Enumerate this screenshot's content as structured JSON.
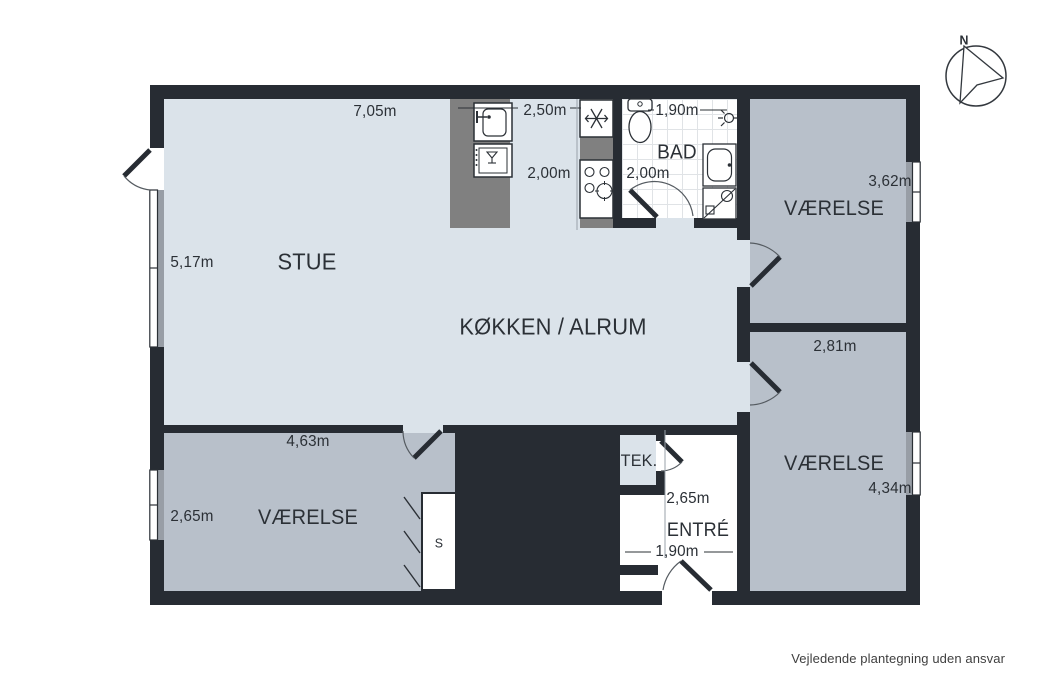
{
  "rooms": {
    "stue": "STUE",
    "kokken": "KØKKEN / ALRUM",
    "bad": "BAD",
    "vaerelse_ne": "VÆRELSE",
    "vaerelse_se": "VÆRELSE",
    "vaerelse_sw": "VÆRELSE",
    "tek": "TEK.",
    "entre": "ENTRÉ",
    "closet": "S"
  },
  "dims": {
    "stue_top": "7,05m",
    "kitchen_top": "2,50m",
    "kitchen_left": "2,00m",
    "bad_top": "1,90m",
    "bad_left": "2,00m",
    "stue_left": "5,17m",
    "ne_width": "3,62m",
    "se_top": "2,81m",
    "se_height": "4,34m",
    "sw_top": "4,63m",
    "sw_left": "2,65m",
    "entre_height": "2,65m",
    "entre_width": "1,90m"
  },
  "compass": {
    "north_label": "N"
  },
  "footer": {
    "disclaimer": "Vejledende plantegning uden ansvar"
  },
  "icons": [
    "compass-north-arrow",
    "toilet",
    "shower-head",
    "washbasin",
    "washing-machine",
    "freezer-snowflake",
    "stove-burners",
    "kitchen-sink",
    "dishwasher",
    "door-swing",
    "window"
  ],
  "colors": {
    "wall": "#272c33",
    "floor_light": "#dbe3ea",
    "floor_room": "#b8c0ca",
    "counter": "#808080",
    "fixture": "#2b3036",
    "window_gray": "#989ea6",
    "tile_line": "#e0e3e6",
    "text": "#2b3036",
    "muted_line": "#9aa2aa",
    "disclaimer": "#3f3f3f",
    "bg": "#ffffff"
  }
}
